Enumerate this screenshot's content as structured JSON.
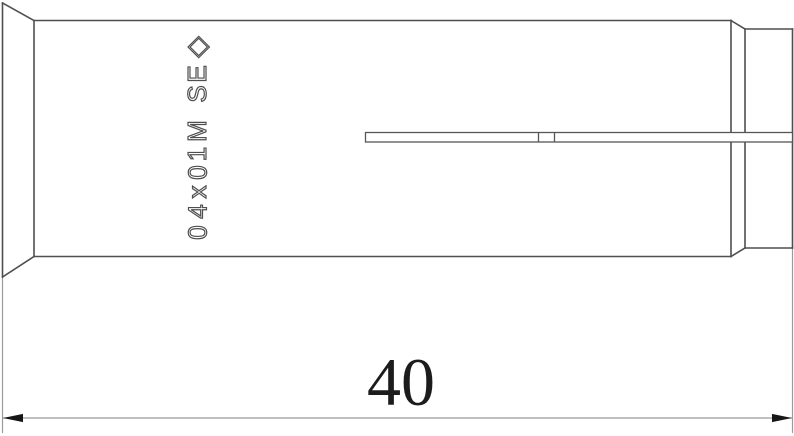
{
  "part_drawing": {
    "engraving": {
      "symbol": "◇",
      "text": "ES M10x40",
      "chars": "◇ES M10x40"
    },
    "dimension_length": {
      "label": "40"
    }
  },
  "colors": {
    "part_line": "#4f4f4f",
    "dimension_line": "#9b9b9b",
    "arrow": "#161616",
    "dimension_text": "#1c1c1c",
    "background": "#ffffff"
  }
}
